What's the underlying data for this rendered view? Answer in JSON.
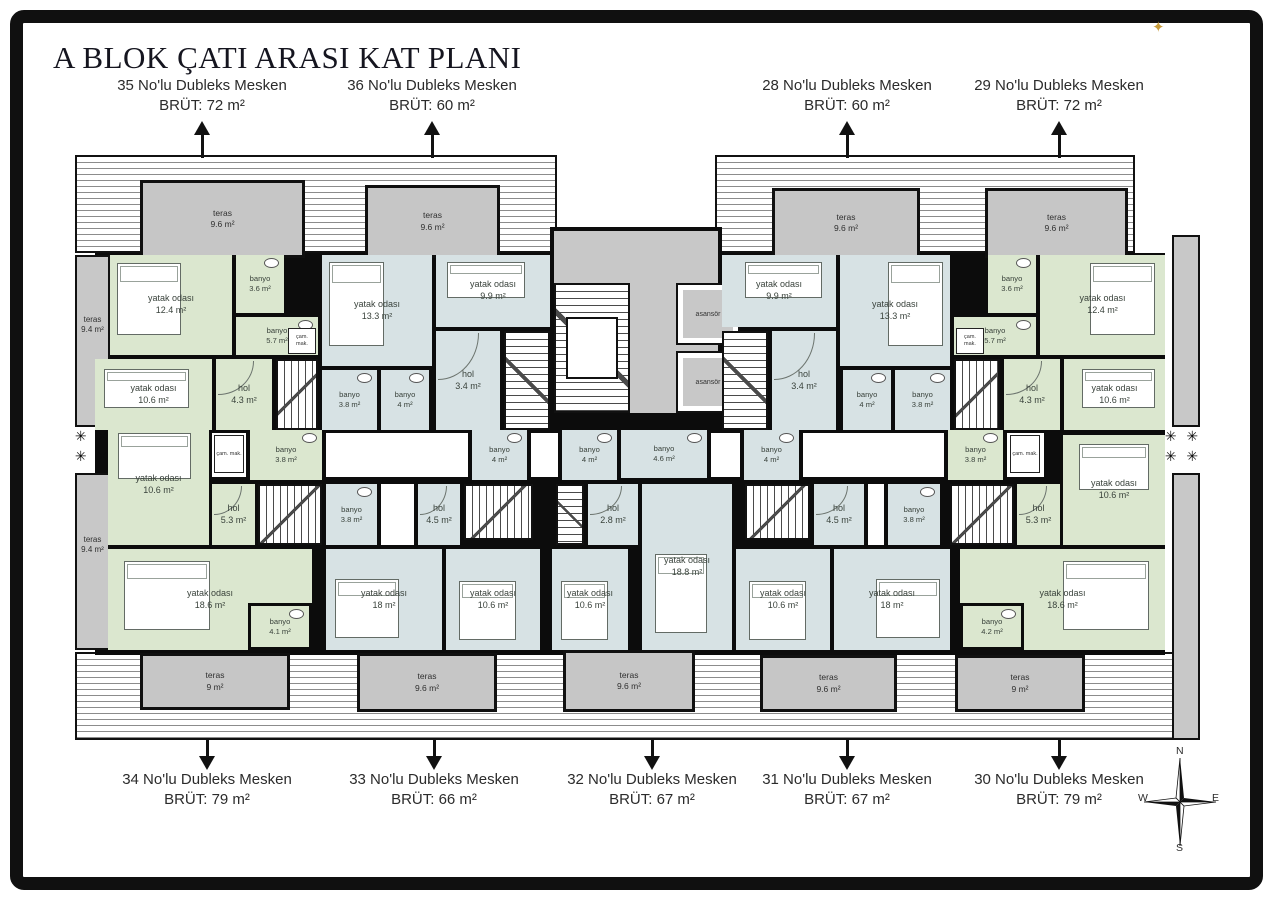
{
  "title": "A BLOK ÇATI ARASI KAT PLANI",
  "decor_star": "✦",
  "plants": "✳ ✳\n✳ ✳",
  "compass": {
    "n": "N",
    "e": "E",
    "s": "S",
    "w": "W"
  },
  "units_top": [
    {
      "name": "35 No'lu Dubleks Mesken",
      "brut": "BRÜT: 72 m²"
    },
    {
      "name": "36 No'lu Dubleks Mesken",
      "brut": "BRÜT: 60 m²"
    },
    {
      "name": "28 No'lu Dubleks Mesken",
      "brut": "BRÜT: 60 m²"
    },
    {
      "name": "29 No'lu Dubleks Mesken",
      "brut": "BRÜT: 72 m²"
    }
  ],
  "units_bottom": [
    {
      "name": "34 No'lu Dubleks Mesken",
      "brut": "BRÜT: 79 m²"
    },
    {
      "name": "33 No'lu Dubleks Mesken",
      "brut": "BRÜT: 66 m²"
    },
    {
      "name": "32 No'lu Dubleks Mesken",
      "brut": "BRÜT: 67 m²"
    },
    {
      "name": "31 No'lu Dubleks Mesken",
      "brut": "BRÜT: 67 m²"
    },
    {
      "name": "30 No'lu Dubleks Mesken",
      "brut": "BRÜT: 79 m²"
    }
  ],
  "plan": {
    "elevator_label": "asansör",
    "closet_label": "çam. mak.",
    "terraces": [
      {
        "name": "teras",
        "area": "9.6 m²"
      },
      {
        "name": "teras",
        "area": "9.6 m²"
      },
      {
        "name": "teras",
        "area": "9.6 m²"
      },
      {
        "name": "teras",
        "area": "9.6 m²"
      },
      {
        "name": "teras",
        "area": "9.4 m²"
      },
      {
        "name": "teras",
        "area": "9.4 m²"
      },
      {
        "name": "teras",
        "area": "9 m²"
      },
      {
        "name": "teras",
        "area": "9.6 m²"
      },
      {
        "name": "teras",
        "area": "9.6 m²"
      },
      {
        "name": "teras",
        "area": "9.6 m²"
      },
      {
        "name": "teras",
        "area": "9 m²"
      }
    ],
    "rooms": [
      {
        "name": "yatak odası",
        "area": "12.4 m²"
      },
      {
        "name": "banyo",
        "area": "3.6 m²"
      },
      {
        "name": "banyo",
        "area": "5.7 m²"
      },
      {
        "name": "yatak odası",
        "area": "10.6 m²"
      },
      {
        "name": "hol",
        "area": "4.3 m²"
      },
      {
        "name": "yatak odası",
        "area": "13.3 m²"
      },
      {
        "name": "yatak odası",
        "area": "9.9 m²"
      },
      {
        "name": "banyo",
        "area": "3.8 m²"
      },
      {
        "name": "banyo",
        "area": "4 m²"
      },
      {
        "name": "hol",
        "area": "3.4 m²"
      },
      {
        "name": "yatak odası",
        "area": "9.9 m²"
      },
      {
        "name": "yatak odası",
        "area": "13.3 m²"
      },
      {
        "name": "hol",
        "area": "3.4 m²"
      },
      {
        "name": "banyo",
        "area": "4 m²"
      },
      {
        "name": "banyo",
        "area": "3.8 m²"
      },
      {
        "name": "banyo",
        "area": "3.6 m²"
      },
      {
        "name": "banyo",
        "area": "5.7 m²"
      },
      {
        "name": "yatak odası",
        "area": "12.4 m²"
      },
      {
        "name": "hol",
        "area": "4.3 m²"
      },
      {
        "name": "yatak odası",
        "area": "10.6 m²"
      },
      {
        "name": "banyo",
        "area": "3.8 m²"
      },
      {
        "name": "yatak odası",
        "area": "10.6 m²"
      },
      {
        "name": "hol",
        "area": "5.3 m²"
      },
      {
        "name": "yatak odası",
        "area": "18.6 m²"
      },
      {
        "name": "banyo",
        "area": "4.1 m²"
      },
      {
        "name": "banyo",
        "area": "3.8 m²"
      },
      {
        "name": "banyo",
        "area": "4 m²"
      },
      {
        "name": "hol",
        "area": "4.5 m²"
      },
      {
        "name": "yatak odası",
        "area": "18 m²"
      },
      {
        "name": "yatak odası",
        "area": "10.6 m²"
      },
      {
        "name": "banyo",
        "area": "4 m²"
      },
      {
        "name": "banyo",
        "area": "4.6 m²"
      },
      {
        "name": "hol",
        "area": "2.8 m²"
      },
      {
        "name": "yatak odası",
        "area": "10.6 m²"
      },
      {
        "name": "yatak odası",
        "area": "18.8 m²"
      },
      {
        "name": "banyo",
        "area": "4 m²"
      },
      {
        "name": "hol",
        "area": "4.5 m²"
      },
      {
        "name": "banyo",
        "area": "3.8 m²"
      },
      {
        "name": "yatak odası",
        "area": "10.6 m²"
      },
      {
        "name": "yatak odası",
        "area": "18 m²"
      },
      {
        "name": "banyo",
        "area": "3.8 m²"
      },
      {
        "name": "hol",
        "area": "5.3 m²"
      },
      {
        "name": "yatak odası",
        "area": "10.6 m²"
      },
      {
        "name": "yatak odası",
        "area": "18.6 m²"
      },
      {
        "name": "banyo",
        "area": "4.2 m²"
      }
    ]
  }
}
